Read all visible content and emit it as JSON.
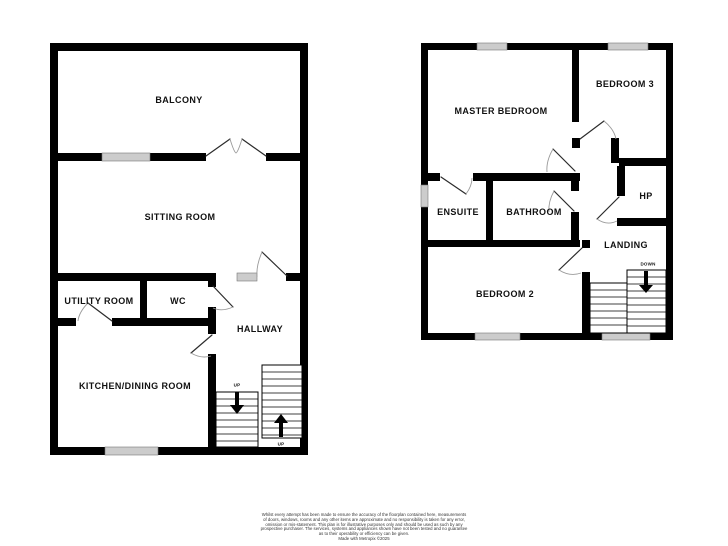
{
  "plans": {
    "ground": {
      "rooms": {
        "balcony": "BALCONY",
        "sitting_room": "SITTING ROOM",
        "utility_room": "UTILITY ROOM",
        "wc": "WC",
        "hallway": "HALLWAY",
        "kitchen_dining_room": "KITCHEN/DINING ROOM"
      },
      "stairs": {
        "upper_flight_label": "UP",
        "lower_flight_label": "UP"
      }
    },
    "first": {
      "rooms": {
        "master_bedroom": "MASTER BEDROOM",
        "bedroom_3": "BEDROOM 3",
        "ensuite": "ENSUITE",
        "bathroom": "BATHROOM",
        "hp": "HP",
        "landing": "LANDING",
        "bedroom_2": "BEDROOM 2"
      },
      "stairs": {
        "label": "DOWN"
      }
    }
  },
  "disclaimer": {
    "lines": [
      "Whilst every attempt has been made to ensure the accuracy of the floorplan contained here, measurements",
      "of doors, windows, rooms and any other items are approximate and no responsibility is taken for any error,",
      "omission or mis-statement. This plan is for illustrative purposes only and should be used as such by any",
      "prospective purchaser. The services, systems and appliances shown have not been tested and no guarantee",
      "as to their operability or efficiency can be given.",
      "Made with Metropix ©2025"
    ]
  },
  "colors": {
    "wall": "#000000",
    "window": "#cccccc",
    "door_arc": "#9a9a9a",
    "text": "#111111"
  }
}
